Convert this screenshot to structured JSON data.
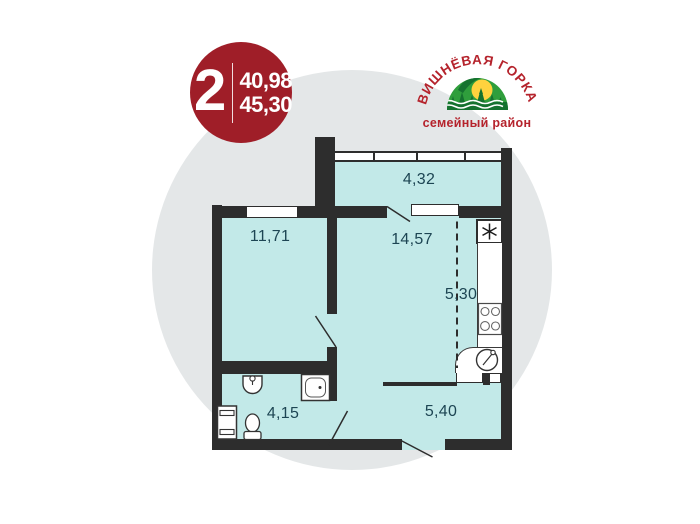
{
  "colors": {
    "bg": "#ffffff",
    "circle": "#e4e7e8",
    "room_fill": "#c2e9e8",
    "wall": "#2d2d2d",
    "label": "#1d4553",
    "badge_bg": "#9f1e28",
    "badge_text": "#ffffff",
    "logo_red": "#b5232c",
    "logo_green": "#2f9e3c",
    "logo_dark_green": "#15722f",
    "logo_sun": "#ffd23e"
  },
  "badge": {
    "room_count": "2",
    "area_top": "40,98",
    "area_bottom": "45,30"
  },
  "logo": {
    "name": "ВИШНЁВАЯ ГОРКА",
    "tagline": "семейный район"
  },
  "plan": {
    "labels": {
      "balcony": "4,32",
      "room": "11,71",
      "kitchen_living": "14,57",
      "kitchen": "5,30",
      "bathroom": "4,15",
      "hallway": "5,40"
    },
    "icons": [
      "ventilation-shaft-icon",
      "stove-icon",
      "kitchen-sink-icon",
      "bath-icon",
      "washbasin-icon",
      "toilet-icon",
      "washing-machine-icon"
    ]
  }
}
